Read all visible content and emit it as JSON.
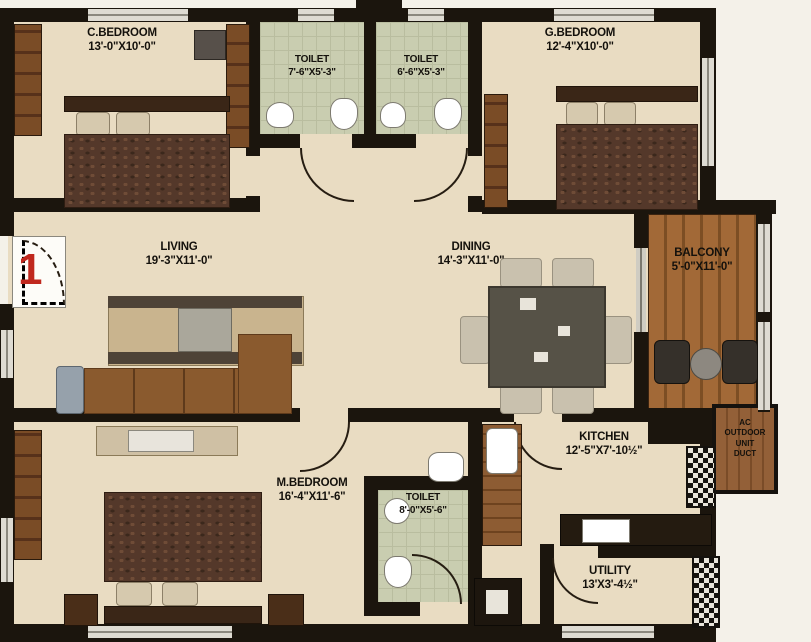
{
  "plan": {
    "unit_number": "1",
    "rooms": [
      {
        "id": "c-bedroom",
        "name": "C.BEDROOM",
        "dims": "13'-0\"X10'-0\""
      },
      {
        "id": "toilet-1",
        "name": "TOILET",
        "dims": "7'-6\"X5'-3\""
      },
      {
        "id": "toilet-2",
        "name": "TOILET",
        "dims": "6'-6\"X5'-3\""
      },
      {
        "id": "g-bedroom",
        "name": "G.BEDROOM",
        "dims": "12'-4\"X10'-0\""
      },
      {
        "id": "living",
        "name": "LIVING",
        "dims": "19'-3\"X11'-0\""
      },
      {
        "id": "dining",
        "name": "DINING",
        "dims": "14'-3\"X11'-0\""
      },
      {
        "id": "balcony",
        "name": "BALCONY",
        "dims": "5'-0\"X11'-0\""
      },
      {
        "id": "kitchen",
        "name": "KITCHEN",
        "dims": "12'-5\"X7'-10½\""
      },
      {
        "id": "m-bedroom",
        "name": "M.BEDROOM",
        "dims": "16'-4\"X11'-6\""
      },
      {
        "id": "toilet-3",
        "name": "TOILET",
        "dims": "8'-0\"X5'-6\""
      },
      {
        "id": "utility",
        "name": "UTILITY",
        "dims": "13'X3'-4½\""
      }
    ],
    "duct_label": "AC\nOUTDOOR\nUNIT\nDUCT",
    "colors": {
      "floor": "#e9dcc2",
      "wall": "#1b150d",
      "wood": "#a26937",
      "tile": "#c9cdb0",
      "accent_red": "#c0281e"
    }
  }
}
